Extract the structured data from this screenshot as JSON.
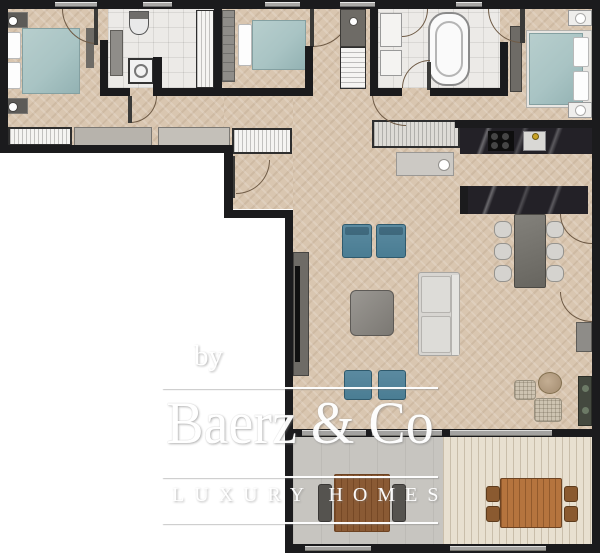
{
  "watermark": {
    "prefix": "by",
    "brand": "Baerz & Co",
    "tagline": "LUXURY HOMES"
  },
  "palette": {
    "wall": "#1b1b1d",
    "parquet": "#d9c6b0",
    "tile": "#eceae7",
    "teal_fabric": "#4a7d93",
    "bed_linen": "#a9c4c4",
    "marble": "#232127",
    "sofa": "#d7d5d1",
    "terrace_deck": "#e8e0d0",
    "terrace_stone": "#c7c5c0",
    "outdoor_wood": "#b5743e",
    "watermark_text": "#ffffff"
  }
}
